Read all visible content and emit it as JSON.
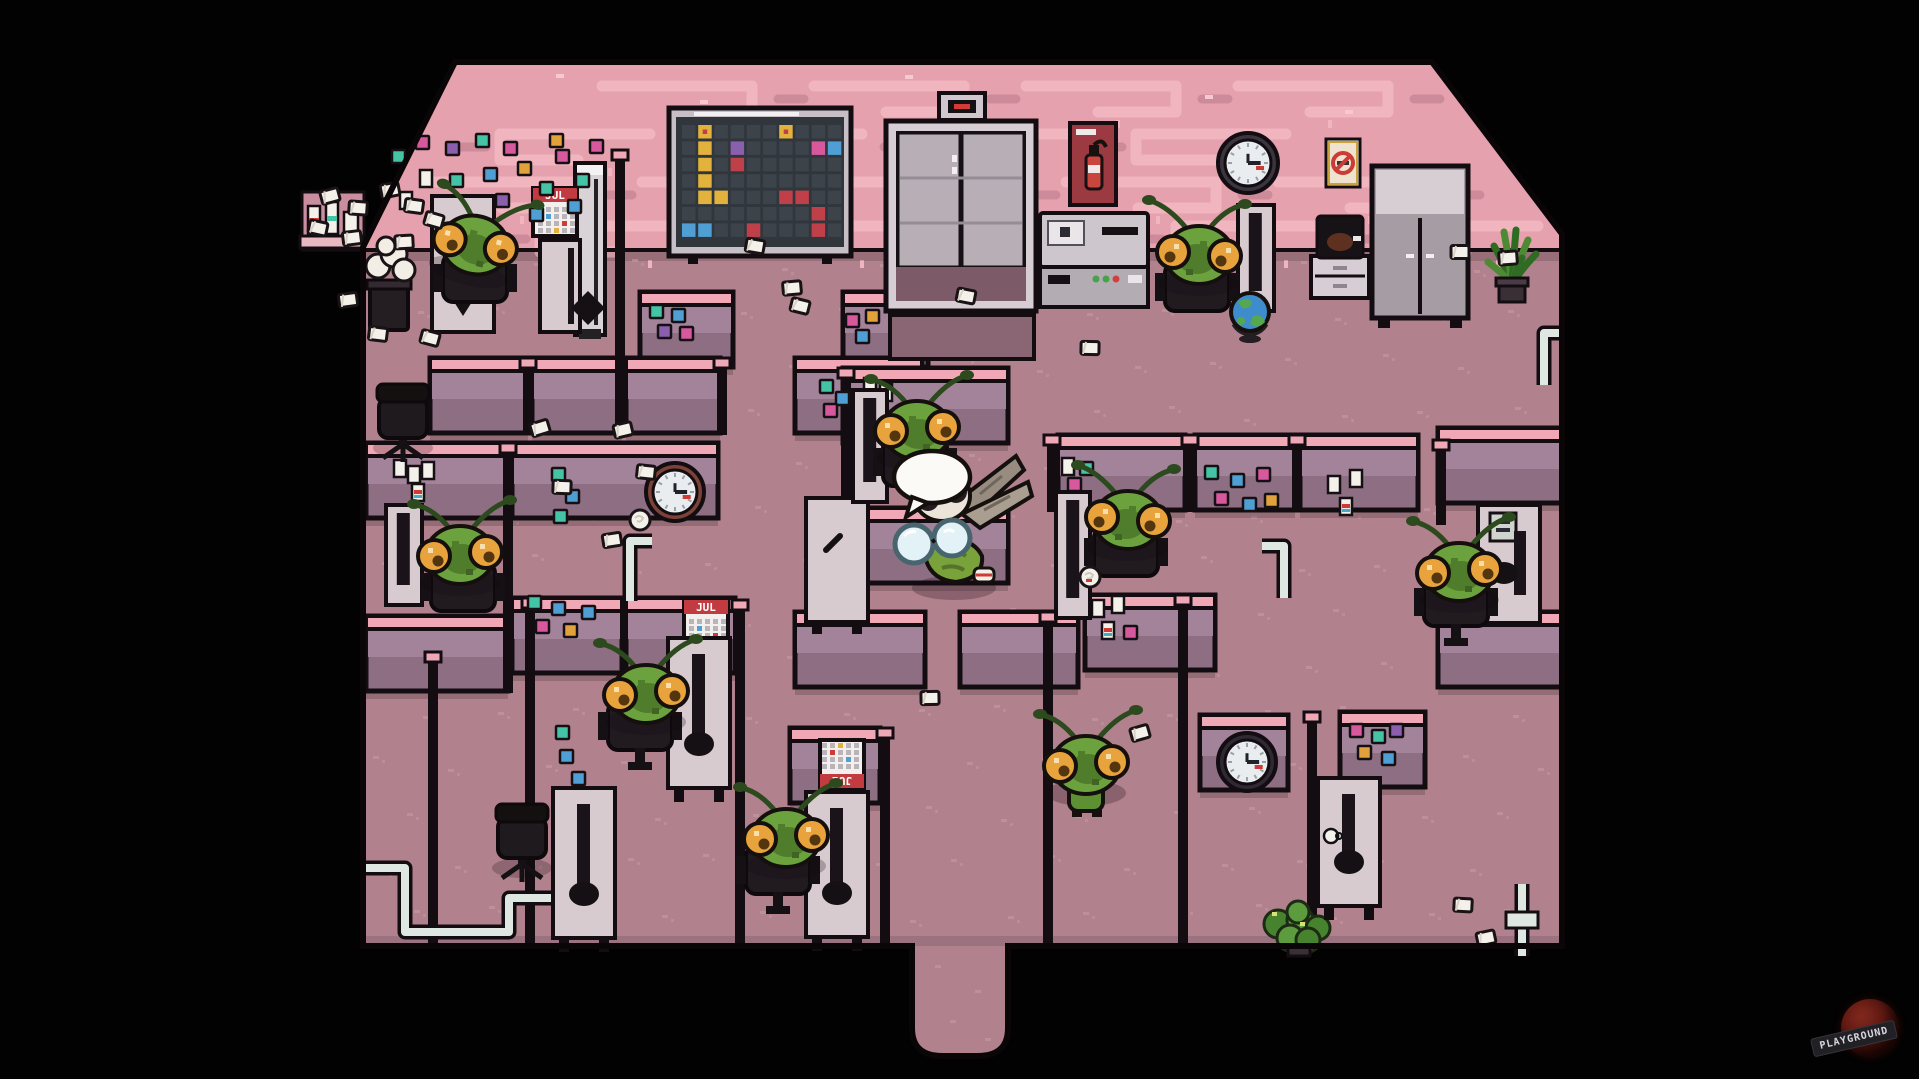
{
  "watermark": {
    "text": "PLAYGROUND"
  },
  "labels": {
    "calendar_month": "JUL"
  },
  "palette": {
    "background": "#000000",
    "wall_pink": "#e5a1ae",
    "wall_pattern_light": "#f0b5bf",
    "wall_pattern_dark": "#cd8b99",
    "floor": "#b1818d",
    "floor_speckle": "#c59ca7",
    "outline": "#130d12",
    "cubicle_cap": "#f1a8b6",
    "cubicle_face_top": "#a28399",
    "cubicle_face_bottom": "#8d6e83",
    "desk_light": "#d7cbd0",
    "furniture_dark": "#1d171c",
    "mantis_green": "#6ca23e",
    "mantis_shade": "#4f7d2c",
    "eye_orange": "#e8a33c",
    "player_cream": "#ece4d8",
    "wing_gray": "#a99e90",
    "glass_blue": "#e3f2f6",
    "t": "#45c4a5",
    "b": "#4f9fd4",
    "p": "#d8589d",
    "o": "#e2a23b",
    "v": "#8a5fae",
    "paper_white": "#f4f0ea",
    "pipe_light": "#dfe7e3",
    "elevator_door": "#b7aeb6",
    "poster_red": "#9c3a42",
    "cal_red": "#c23b40",
    "board_dark": "#30363c",
    "board_cell": "#3c434a",
    "y": "#e2b23c",
    "r": "#c0404a"
  },
  "board_cells": [
    [
      1,
      0,
      "y",
      1
    ],
    [
      6,
      0,
      "y",
      1
    ],
    [
      1,
      1,
      "y",
      0
    ],
    [
      1,
      2,
      "y",
      0
    ],
    [
      1,
      3,
      "y",
      0
    ],
    [
      1,
      4,
      "y",
      0
    ],
    [
      2,
      4,
      "y",
      0
    ],
    [
      3,
      1,
      "v",
      0
    ],
    [
      3,
      2,
      "r",
      1
    ],
    [
      8,
      1,
      "p",
      0
    ],
    [
      9,
      1,
      "b",
      0
    ],
    [
      6,
      4,
      "r",
      0
    ],
    [
      7,
      4,
      "r",
      0
    ],
    [
      8,
      5,
      "r",
      0
    ],
    [
      8,
      6,
      "r",
      0
    ],
    [
      0,
      6,
      "b",
      0
    ],
    [
      1,
      6,
      "b",
      0
    ],
    [
      4,
      6,
      "r",
      0
    ]
  ],
  "scene": {
    "entities": [
      {
        "t": "pipe",
        "name": "floor-pipe-left",
        "d": "M363,868 h42 v64 h104 v-34 h46"
      },
      {
        "t": "pipe",
        "name": "floor-pipe-mid-left",
        "d": "M652,541 h-22 v60"
      },
      {
        "t": "pipe",
        "name": "floor-pipe-mid-right",
        "d": "M1262,546 h22 v52"
      },
      {
        "t": "pipe",
        "name": "wall-pipe-right",
        "d": "M1562,333 h-18 v52"
      },
      {
        "t": "pipe",
        "name": "floor-pipe-bottom-right",
        "d": "M1522,884 v72"
      },
      {
        "t": "coupling",
        "name": "pipe-coupling",
        "x": 1506,
        "y": 912
      },
      {
        "t": "elevator",
        "name": "elevator",
        "x": 886,
        "y": 93
      },
      {
        "t": "board",
        "name": "bulletin-board",
        "x": 676,
        "y": 117
      },
      {
        "t": "poster",
        "name": "fire-extinguisher-poster",
        "x": 1070,
        "y": 123
      },
      {
        "t": "clock",
        "name": "wall-clock",
        "x": 1248,
        "y": 163,
        "r": 23,
        "frame": "#3b3540"
      },
      {
        "t": "nosmoke",
        "name": "no-smoking-sign",
        "x": 1326,
        "y": 139
      },
      {
        "t": "cabinet",
        "name": "storage-cabinet",
        "x": 1372,
        "y": 166
      },
      {
        "t": "copier",
        "name": "copier-machine",
        "x": 1040,
        "y": 213
      },
      {
        "t": "coffee",
        "name": "coffee-station",
        "x": 1311,
        "y": 216
      },
      {
        "t": "cooler",
        "name": "water-cooler",
        "x": 575,
        "y": 163
      },
      {
        "t": "shelf",
        "name": "wall-shelf",
        "x": 300,
        "y": 196
      },
      {
        "t": "trash",
        "name": "overflowing-trash-bin",
        "x": 366,
        "y": 240
      },
      {
        "t": "plant",
        "name": "potted-plant",
        "x": 1487,
        "y": 226,
        "v": "tall"
      },
      {
        "t": "plant",
        "name": "potted-plant",
        "x": 1270,
        "y": 908,
        "v": "bush"
      },
      {
        "t": "calendar",
        "name": "wall-calendar",
        "x": 533,
        "y": 188,
        "rot": 0
      },
      {
        "t": "notes",
        "name": "sticky-notes",
        "x": 392,
        "y": 134,
        "items": [
          [
            0,
            16,
            "t"
          ],
          [
            24,
            2,
            "p"
          ],
          [
            54,
            8,
            "v"
          ],
          [
            84,
            0,
            "t"
          ],
          [
            112,
            8,
            "p"
          ],
          [
            28,
            36,
            "w"
          ],
          [
            58,
            40,
            "t"
          ],
          [
            92,
            34,
            "b"
          ],
          [
            8,
            58,
            "w"
          ],
          [
            42,
            64,
            "b"
          ],
          [
            74,
            62,
            "w"
          ],
          [
            126,
            28,
            "o"
          ],
          [
            148,
            48,
            "t"
          ],
          [
            104,
            60,
            "v"
          ],
          [
            138,
            74,
            "b"
          ],
          [
            164,
            16,
            "p"
          ],
          [
            184,
            40,
            "t"
          ],
          [
            198,
            6,
            "p"
          ],
          [
            158,
            0,
            "o"
          ],
          [
            176,
            66,
            "b"
          ]
        ]
      },
      {
        "t": "notes",
        "name": "sticky-notes",
        "x": 650,
        "y": 305,
        "items": [
          [
            0,
            0,
            "t"
          ],
          [
            22,
            4,
            "b"
          ],
          [
            8,
            20,
            "v"
          ],
          [
            30,
            22,
            "p"
          ]
        ]
      },
      {
        "t": "notes",
        "name": "sticky-notes",
        "x": 846,
        "y": 310,
        "items": [
          [
            0,
            4,
            "p"
          ],
          [
            20,
            0,
            "o"
          ],
          [
            10,
            20,
            "b"
          ]
        ]
      },
      {
        "t": "notes",
        "name": "sticky-notes",
        "x": 820,
        "y": 380,
        "items": [
          [
            0,
            0,
            "t"
          ],
          [
            16,
            12,
            "b"
          ],
          [
            4,
            24,
            "p"
          ]
        ]
      },
      {
        "t": "notes",
        "name": "sticky-notes",
        "x": 552,
        "y": 468,
        "items": [
          [
            0,
            0,
            "t"
          ],
          [
            14,
            22,
            "b"
          ],
          [
            2,
            42,
            "t"
          ]
        ]
      },
      {
        "t": "notes",
        "name": "sticky-notes",
        "x": 1062,
        "y": 456,
        "items": [
          [
            0,
            2,
            "w"
          ],
          [
            18,
            6,
            "t"
          ],
          [
            6,
            22,
            "p"
          ]
        ]
      },
      {
        "t": "notes",
        "name": "sticky-notes",
        "x": 1203,
        "y": 466,
        "items": [
          [
            2,
            0,
            "t"
          ],
          [
            28,
            8,
            "b"
          ],
          [
            54,
            2,
            "p"
          ],
          [
            12,
            26,
            "p"
          ],
          [
            40,
            32,
            "b"
          ],
          [
            62,
            28,
            "o"
          ]
        ]
      },
      {
        "t": "notes",
        "name": "pinned-papers",
        "x": 1328,
        "y": 470,
        "items": [
          [
            0,
            6,
            "w"
          ],
          [
            22,
            0,
            "w"
          ],
          [
            12,
            28,
            "wr"
          ]
        ]
      },
      {
        "t": "notes",
        "name": "sticky-notes",
        "x": 528,
        "y": 594,
        "items": [
          [
            0,
            2,
            "t"
          ],
          [
            24,
            8,
            "b"
          ],
          [
            8,
            26,
            "p"
          ],
          [
            36,
            30,
            "o"
          ],
          [
            54,
            12,
            "b"
          ]
        ]
      },
      {
        "t": "notes",
        "name": "sticky-notes",
        "x": 556,
        "y": 726,
        "items": [
          [
            0,
            0,
            "t"
          ],
          [
            4,
            24,
            "b"
          ],
          [
            16,
            46,
            "b"
          ]
        ]
      },
      {
        "t": "notes",
        "name": "pinned-papers",
        "x": 1092,
        "y": 596,
        "items": [
          [
            0,
            4,
            "w"
          ],
          [
            20,
            0,
            "w"
          ],
          [
            10,
            26,
            "wr"
          ],
          [
            32,
            30,
            "p"
          ]
        ]
      },
      {
        "t": "notes",
        "name": "sticky-notes",
        "x": 1346,
        "y": 724,
        "items": [
          [
            4,
            0,
            "p"
          ],
          [
            26,
            6,
            "t"
          ],
          [
            44,
            0,
            "v"
          ],
          [
            12,
            22,
            "o"
          ],
          [
            36,
            28,
            "b"
          ]
        ]
      },
      {
        "t": "notes",
        "name": "pinned-papers",
        "x": 864,
        "y": 378,
        "items": [
          [
            0,
            0,
            "w"
          ],
          [
            16,
            6,
            "w"
          ]
        ]
      },
      {
        "t": "notes",
        "name": "pinned-papers",
        "x": 394,
        "y": 460,
        "items": [
          [
            0,
            0,
            "w"
          ],
          [
            14,
            6,
            "w"
          ],
          [
            28,
            2,
            "w"
          ],
          [
            18,
            24,
            "wr"
          ]
        ]
      },
      {
        "t": "clock",
        "name": "wall-clock",
        "x": 675,
        "y": 492,
        "r": 22,
        "frame": "#7c4238"
      },
      {
        "t": "clock",
        "name": "wall-clock",
        "x": 1247,
        "y": 762,
        "r": 22,
        "frame": "#2e2933"
      },
      {
        "t": "calendar",
        "name": "wall-calendar",
        "x": 684,
        "y": 600,
        "rot": 0
      },
      {
        "t": "calendar",
        "name": "wall-calendar",
        "x": 820,
        "y": 740,
        "rot": 180
      },
      {
        "t": "deskunit",
        "name": "cubicle-desk",
        "x": 432,
        "y": 196,
        "h": 136,
        "v": "chevrons"
      },
      {
        "t": "deskunit",
        "name": "cubicle-desk",
        "x": 540,
        "y": 240,
        "h": 92,
        "w": 40,
        "v": "plain"
      },
      {
        "t": "deskunit",
        "name": "cubicle-desk",
        "x": 806,
        "y": 498,
        "h": 124,
        "v": "board"
      },
      {
        "t": "deskunit",
        "name": "cubicle-desk",
        "x": 1478,
        "y": 505,
        "h": 118,
        "v": "pic"
      },
      {
        "t": "deskunit",
        "name": "cubicle-desk",
        "x": 806,
        "y": 792,
        "h": 145,
        "v": "tall"
      },
      {
        "t": "deskunit",
        "name": "cubicle-desk",
        "x": 668,
        "y": 638,
        "h": 150,
        "v": "tall"
      },
      {
        "t": "deskunit",
        "name": "cubicle-desk",
        "x": 553,
        "y": 788,
        "h": 150,
        "v": "tall"
      },
      {
        "t": "deskunit",
        "name": "cubicle-desk",
        "x": 1318,
        "y": 778,
        "h": 128,
        "v": "cup"
      },
      {
        "t": "desk",
        "name": "workstation-desk",
        "x": 386,
        "y": 505,
        "w": 36,
        "h": 100
      },
      {
        "t": "desk",
        "name": "workstation-desk",
        "x": 1238,
        "y": 205,
        "w": 36,
        "h": 106
      },
      {
        "t": "desk",
        "name": "workstation-desk",
        "x": 1056,
        "y": 492,
        "w": 34,
        "h": 126
      },
      {
        "t": "desk",
        "name": "workstation-desk",
        "x": 853,
        "y": 390,
        "w": 34,
        "h": 112
      },
      {
        "t": "chairE",
        "name": "empty-office-chair",
        "x": 403,
        "y": 418
      },
      {
        "t": "chairE",
        "name": "empty-office-chair",
        "x": 522,
        "y": 838
      },
      {
        "t": "seat",
        "name": "office-chair",
        "x": 475,
        "y": 278
      },
      {
        "t": "mantis",
        "name": "mantis-worker",
        "x": 475,
        "y": 245,
        "rot": 15
      },
      {
        "t": "seat",
        "name": "office-chair",
        "x": 1197,
        "y": 287
      },
      {
        "t": "mantis",
        "name": "mantis-worker",
        "x": 1199,
        "y": 255,
        "flip": 1
      },
      {
        "t": "globe",
        "name": "desk-globe",
        "x": 1250,
        "y": 312
      },
      {
        "t": "seat",
        "name": "office-chair",
        "x": 463,
        "y": 587
      },
      {
        "t": "mantis",
        "name": "mantis-worker",
        "x": 460,
        "y": 555
      },
      {
        "t": "seat",
        "name": "office-chair",
        "x": 1126,
        "y": 552
      },
      {
        "t": "mantis",
        "name": "mantis-worker",
        "x": 1128,
        "y": 520,
        "flip": 1
      },
      {
        "t": "seat",
        "name": "office-chair",
        "x": 915,
        "y": 462
      },
      {
        "t": "mantis",
        "name": "mantis-worker",
        "x": 917,
        "y": 430
      },
      {
        "t": "seat",
        "name": "office-chair",
        "x": 1456,
        "y": 602,
        "leg": 1
      },
      {
        "t": "mantis",
        "name": "mantis-worker",
        "x": 1459,
        "y": 572
      },
      {
        "t": "mantis",
        "name": "mantis-worker",
        "x": 1086,
        "y": 765,
        "standing": 1
      },
      {
        "t": "seat",
        "name": "office-chair",
        "x": 778,
        "y": 870,
        "leg": 1
      },
      {
        "t": "mantis",
        "name": "mantis-worker",
        "x": 786,
        "y": 838
      },
      {
        "t": "seat",
        "name": "office-chair",
        "x": 640,
        "y": 726,
        "leg": 1
      },
      {
        "t": "mantis",
        "name": "mantis-worker",
        "x": 646,
        "y": 694
      },
      {
        "t": "papers",
        "name": "paper-scraps",
        "list": [
          [
            540,
            428
          ],
          [
            562,
            487
          ],
          [
            623,
            430
          ],
          [
            646,
            472
          ],
          [
            612,
            540
          ],
          [
            755,
            246
          ],
          [
            792,
            288
          ],
          [
            800,
            306
          ],
          [
            930,
            698
          ],
          [
            1140,
            733
          ],
          [
            1463,
            905
          ],
          [
            1486,
            938
          ],
          [
            378,
            334
          ],
          [
            348,
            300
          ],
          [
            966,
            296
          ],
          [
            1508,
            258
          ],
          [
            430,
            338
          ],
          [
            1460,
            252
          ],
          [
            330,
            196
          ],
          [
            358,
            208
          ],
          [
            390,
            190
          ],
          [
            414,
            206
          ],
          [
            352,
            238
          ],
          [
            318,
            228
          ],
          [
            404,
            242
          ],
          [
            434,
            220
          ],
          [
            1090,
            348
          ]
        ]
      },
      {
        "t": "crumple",
        "name": "crumpled-paper",
        "x": 640,
        "y": 520
      },
      {
        "t": "crumple",
        "name": "crumpled-paper",
        "x": 1090,
        "y": 577,
        "red": 1
      },
      {
        "t": "player",
        "name": "player-character",
        "x": 950,
        "y": 516
      },
      {
        "t": "bubble",
        "name": "speech-bubble",
        "x": 900,
        "y": 477
      }
    ]
  }
}
